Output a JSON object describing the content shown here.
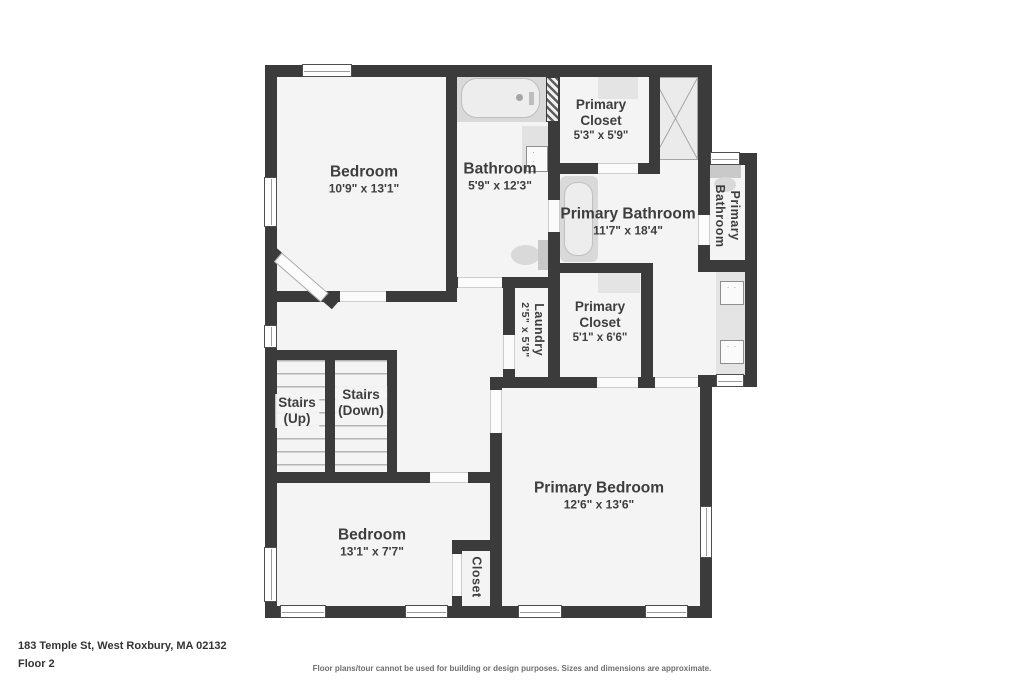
{
  "address": "183 Temple St, West Roxbury, MA 02132",
  "floor_label": "Floor 2",
  "disclaimer": "Floor plans/tour cannot be used for building or design purposes. Sizes and dimensions are approximate.",
  "colors": {
    "wall": "#3b3b3c",
    "floor": "#f4f4f4",
    "fixture_gray": "#d9d9d9",
    "text": "#3e3e3e",
    "page_background": "#ffffff"
  },
  "rooms": {
    "bedroom1": {
      "name": "Bedroom",
      "dims": "10'9\" x 13'1\""
    },
    "bathroom": {
      "name": "Bathroom",
      "dims": "5'9\" x 12'3\""
    },
    "primary_closet_top": {
      "name": "Primary\nCloset",
      "dims": "5'3\" x 5'9\""
    },
    "primary_bathroom": {
      "name": "Primary Bathroom",
      "dims": "11'7\" x 18'4\""
    },
    "primary_bathroom_small": {
      "name": "Primary\nBathroom"
    },
    "laundry": {
      "name": "Laundry",
      "dims": "2'5\" x 5'8\""
    },
    "primary_closet_mid": {
      "name": "Primary\nCloset",
      "dims": "5'1\" x 6'6\""
    },
    "stairs_up": {
      "name": "Stairs\n(Up)"
    },
    "stairs_down": {
      "name": "Stairs\n(Down)"
    },
    "bedroom2": {
      "name": "Bedroom",
      "dims": "13'1\" x 7'7\""
    },
    "closet": {
      "name": "Closet"
    },
    "primary_bedroom": {
      "name": "Primary Bedroom",
      "dims": "12'6\" x 13'6\""
    }
  }
}
